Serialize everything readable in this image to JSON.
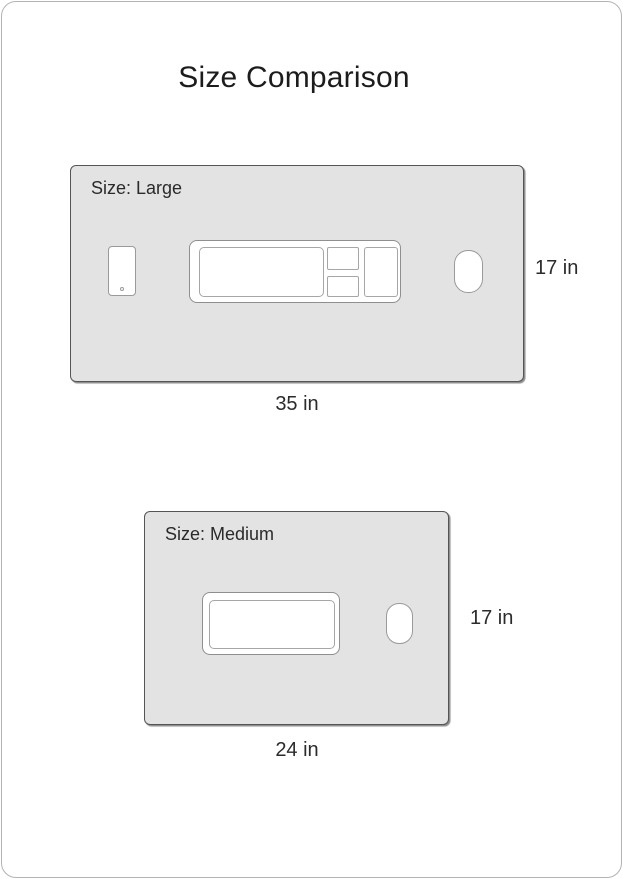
{
  "title": "Size Comparison",
  "colors": {
    "panel_fill": "#e3e3e3",
    "panel_border": "#555555",
    "cutout_fill": "#ffffff",
    "cutout_border": "#9a9a9a",
    "card_border": "#b3b3b3",
    "text": "#2a2a2a"
  },
  "sizes": {
    "large": {
      "label": "Size: Large",
      "width_label": "35 in",
      "height_label": "17 in",
      "width_in": 35,
      "height_in": 17
    },
    "medium": {
      "label": "Size: Medium",
      "width_label": "24 in",
      "height_label": "17 in",
      "width_in": 24,
      "height_in": 17
    }
  }
}
